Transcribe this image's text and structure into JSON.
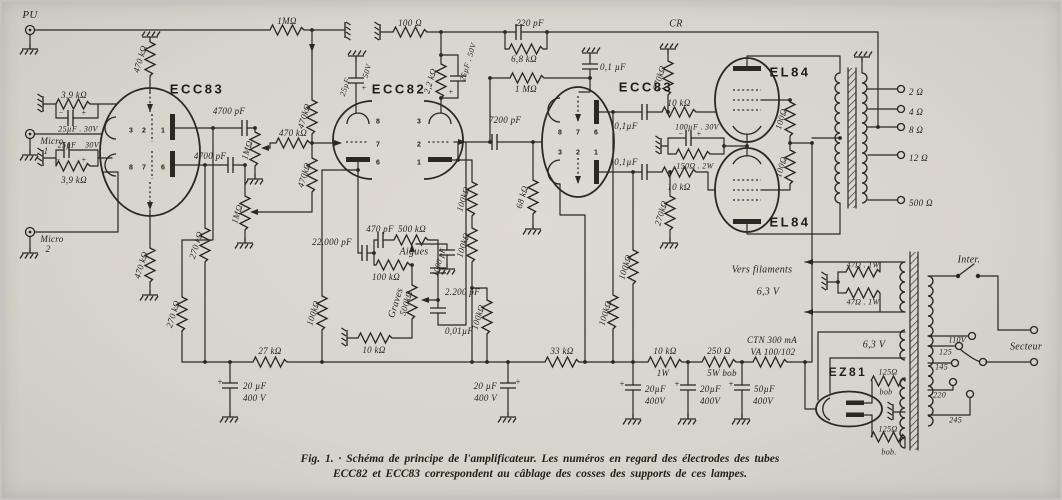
{
  "caption": {
    "line1": "Fig. 1. · Schéma de principe de l'amplificateur. Les numéros en regard des électrodes des tubes",
    "line2": "ECC82 et ECC83 correspondent au câblage des cosses des supports de ces lampes."
  },
  "colors": {
    "paper": "#d7d4cc",
    "ink": "#2b2723"
  },
  "labels": [
    {
      "n": "pu-label",
      "t": "PU",
      "x": 30,
      "y": 15,
      "s": 11
    },
    {
      "n": "micro1-label",
      "t": "Micro",
      "x": 52,
      "y": 141
    },
    {
      "n": "micro1-num",
      "t": "1",
      "x": 46,
      "y": 151
    },
    {
      "n": "micro2-label",
      "t": "Micro",
      "x": 52,
      "y": 239
    },
    {
      "n": "micro2-num",
      "t": "2",
      "x": 48,
      "y": 249
    },
    {
      "n": "r-1m-pu",
      "t": "1MΩ",
      "x": 287,
      "y": 21
    },
    {
      "n": "r-100",
      "t": "100 Ω",
      "x": 410,
      "y": 23
    },
    {
      "n": "c-220p",
      "t": "220 pF",
      "x": 530,
      "y": 23
    },
    {
      "n": "r-6k8",
      "t": "6,8 kΩ",
      "x": 524,
      "y": 59
    },
    {
      "n": "cr-label",
      "t": "CR",
      "x": 676,
      "y": 24,
      "s": 10
    },
    {
      "n": "c-01-c",
      "t": "0,1 µF",
      "x": 600,
      "y": 67,
      "a": "s"
    },
    {
      "n": "r-1m-grid",
      "t": "1 MΩ",
      "x": 526,
      "y": 89
    },
    {
      "n": "tube1-label",
      "t": "ECC83",
      "x": 197,
      "y": 89,
      "c": "tube"
    },
    {
      "n": "r-470k-p1",
      "t": "470 kΩ",
      "x": 140,
      "y": 59,
      "r": -73
    },
    {
      "n": "r-3k9-a",
      "t": "3,9 kΩ",
      "x": 74,
      "y": 95
    },
    {
      "n": "c-25u-a",
      "t": "25µF . 30V",
      "x": 78,
      "y": 129,
      "s": 8
    },
    {
      "n": "sign-m1",
      "t": "−",
      "x": 61,
      "y": 113,
      "s": 8
    },
    {
      "n": "sign-p1",
      "t": "+",
      "x": 84,
      "y": 113,
      "s": 8
    },
    {
      "n": "c-25u-b",
      "t": "25µF",
      "x": 67,
      "y": 145,
      "s": 8
    },
    {
      "n": "v-30-b",
      "t": "30V",
      "x": 92,
      "y": 145,
      "s": 8
    },
    {
      "n": "sign-m2",
      "t": "−",
      "x": 58,
      "y": 160,
      "s": 8
    },
    {
      "n": "sign-p2",
      "t": "+",
      "x": 84,
      "y": 160,
      "s": 8
    },
    {
      "n": "r-3k9-b",
      "t": "3,9 kΩ",
      "x": 74,
      "y": 180
    },
    {
      "n": "c-4700-a",
      "t": "4700 pF",
      "x": 229,
      "y": 111
    },
    {
      "n": "c-4700-b",
      "t": "4700 pF",
      "x": 210,
      "y": 156
    },
    {
      "n": "pot1-label",
      "t": "1MΩ",
      "x": 247,
      "y": 150,
      "r": -73
    },
    {
      "n": "pot2-label",
      "t": "1MΩ",
      "x": 237,
      "y": 214,
      "r": -73
    },
    {
      "n": "r-470k-mix",
      "t": "470 kΩ",
      "x": 293,
      "y": 133
    },
    {
      "n": "r-470k-v1",
      "t": "470kΩ",
      "x": 304,
      "y": 116,
      "r": -73
    },
    {
      "n": "r-470k-v2",
      "t": "470kΩ",
      "x": 304,
      "y": 175,
      "r": -73
    },
    {
      "n": "r-470k-gl",
      "t": "470 kΩ",
      "x": 141,
      "y": 265,
      "r": -73
    },
    {
      "n": "r-270k-a",
      "t": "270 kΩ",
      "x": 196,
      "y": 245,
      "r": -73
    },
    {
      "n": "r-270k-b",
      "t": "270 kΩ",
      "x": 173,
      "y": 314,
      "r": -73
    },
    {
      "n": "pin-t1-3",
      "t": "3",
      "x": 131,
      "y": 131,
      "c": "pin"
    },
    {
      "n": "pin-t1-2",
      "t": "2",
      "x": 144,
      "y": 131,
      "c": "pin"
    },
    {
      "n": "pin-t1-1",
      "t": "1",
      "x": 163,
      "y": 131,
      "c": "pin"
    },
    {
      "n": "pin-t1-8",
      "t": "8",
      "x": 131,
      "y": 168,
      "c": "pin"
    },
    {
      "n": "pin-t1-7",
      "t": "7",
      "x": 144,
      "y": 168,
      "c": "pin"
    },
    {
      "n": "pin-t1-6",
      "t": "6",
      "x": 163,
      "y": 168,
      "c": "pin"
    },
    {
      "n": "c-25u50-a",
      "t": "25µF",
      "x": 345,
      "y": 87,
      "r": -73,
      "s": 8
    },
    {
      "n": "v-50-a",
      "t": "50V",
      "x": 367,
      "y": 71,
      "r": -73,
      "s": 8
    },
    {
      "n": "sign-p10",
      "t": "+",
      "x": 364,
      "y": 88,
      "s": 8
    },
    {
      "n": "tube2-label",
      "t": "ECC82",
      "x": 399,
      "y": 89,
      "c": "tube"
    },
    {
      "n": "r-2k2",
      "t": "2,2 kΩ",
      "x": 430,
      "y": 81,
      "r": -73
    },
    {
      "n": "c-25u50-b",
      "t": "25µF . 50V",
      "x": 468,
      "y": 62,
      "r": -73,
      "s": 8
    },
    {
      "n": "sign-p3",
      "t": "+",
      "x": 451,
      "y": 92,
      "s": 8
    },
    {
      "n": "pin-t2-8",
      "t": "8",
      "x": 378,
      "y": 122,
      "c": "pin"
    },
    {
      "n": "pin-t2-7",
      "t": "7",
      "x": 378,
      "y": 145,
      "c": "pin"
    },
    {
      "n": "pin-t2-6",
      "t": "6",
      "x": 378,
      "y": 163,
      "c": "pin"
    },
    {
      "n": "pin-t2-3",
      "t": "3",
      "x": 419,
      "y": 122,
      "c": "pin"
    },
    {
      "n": "pin-t2-2",
      "t": "2",
      "x": 419,
      "y": 145,
      "c": "pin"
    },
    {
      "n": "pin-t2-1",
      "t": "1",
      "x": 419,
      "y": 163,
      "c": "pin"
    },
    {
      "n": "c-7200",
      "t": "7200 pF",
      "x": 505,
      "y": 120
    },
    {
      "n": "r-68k",
      "t": "68 kΩ",
      "x": 522,
      "y": 197,
      "r": -73
    },
    {
      "n": "c-22000",
      "t": "22.000 pF",
      "x": 332,
      "y": 242
    },
    {
      "n": "c-470p",
      "t": "470 pF",
      "x": 380,
      "y": 229
    },
    {
      "n": "pot-aigues",
      "t": "500 kΩ",
      "x": 412,
      "y": 229
    },
    {
      "n": "aigues-label",
      "t": "Aigues",
      "x": 414,
      "y": 252,
      "s": 10
    },
    {
      "n": "c-1000",
      "t": "1000 pF",
      "x": 439,
      "y": 262,
      "r": -73,
      "s": 8
    },
    {
      "n": "r-100k-tone",
      "t": "100 kΩ",
      "x": 386,
      "y": 277
    },
    {
      "n": "graves-label",
      "t": "Graves",
      "x": 396,
      "y": 303,
      "r": -73,
      "s": 10
    },
    {
      "n": "pot-graves",
      "t": "500kΩ",
      "x": 406,
      "y": 303,
      "r": -73
    },
    {
      "n": "c-2200",
      "t": "2.200  pF",
      "x": 445,
      "y": 292,
      "a": "s"
    },
    {
      "n": "c-001",
      "t": "0,01µF",
      "x": 445,
      "y": 331,
      "a": "s"
    },
    {
      "n": "r-10k-tone",
      "t": "10 kΩ",
      "x": 374,
      "y": 350
    },
    {
      "n": "r-100k-sup",
      "t": "100kΩ",
      "x": 313,
      "y": 313,
      "r": -73
    },
    {
      "n": "r-100k-a",
      "t": "100kΩ",
      "x": 463,
      "y": 199,
      "r": -73
    },
    {
      "n": "r-100k-b",
      "t": "100kΩ",
      "x": 463,
      "y": 245,
      "r": -73
    },
    {
      "n": "r-100k-c",
      "t": "100kΩ",
      "x": 478,
      "y": 317,
      "r": -73
    },
    {
      "n": "tube3-label",
      "t": "ECC83",
      "x": 646,
      "y": 87,
      "c": "tube"
    },
    {
      "n": "pin-t3-8",
      "t": "8",
      "x": 560,
      "y": 133,
      "c": "pin"
    },
    {
      "n": "pin-t3-7",
      "t": "7",
      "x": 578,
      "y": 133,
      "c": "pin"
    },
    {
      "n": "pin-t3-6",
      "t": "6",
      "x": 596,
      "y": 133,
      "c": "pin"
    },
    {
      "n": "pin-t3-3",
      "t": "3",
      "x": 560,
      "y": 153,
      "c": "pin"
    },
    {
      "n": "pin-t3-2",
      "t": "2",
      "x": 578,
      "y": 153,
      "c": "pin"
    },
    {
      "n": "pin-t3-1",
      "t": "1",
      "x": 596,
      "y": 153,
      "c": "pin"
    },
    {
      "n": "r-270k-c",
      "t": "270kΩ",
      "x": 659,
      "y": 78,
      "r": -73
    },
    {
      "n": "r-270k-d",
      "t": "270kΩ",
      "x": 661,
      "y": 213,
      "r": -73
    },
    {
      "n": "c-01-a",
      "t": "0,1µF",
      "x": 626,
      "y": 126
    },
    {
      "n": "c-01-b",
      "t": "0,1µF",
      "x": 626,
      "y": 162
    },
    {
      "n": "r-10k-a",
      "t": "10 kΩ",
      "x": 679,
      "y": 103
    },
    {
      "n": "r-10k-b",
      "t": "10 kΩ",
      "x": 679,
      "y": 187
    },
    {
      "n": "c-100u",
      "t": "100µF . 30V",
      "x": 697,
      "y": 127,
      "s": 8
    },
    {
      "n": "sign-m3",
      "t": "−",
      "x": 681,
      "y": 134,
      "s": 8
    },
    {
      "n": "sign-p4",
      "t": "+",
      "x": 699,
      "y": 134,
      "s": 8
    },
    {
      "n": "r-150",
      "t": "150Ω . 2W",
      "x": 695,
      "y": 166,
      "s": 8
    },
    {
      "n": "r-100k-d",
      "t": "100kΩ",
      "x": 605,
      "y": 313,
      "r": -73
    },
    {
      "n": "r-100k-e",
      "t": "100kΩ",
      "x": 625,
      "y": 267,
      "r": -73
    },
    {
      "n": "tube4-label",
      "t": "EL84",
      "x": 790,
      "y": 72,
      "c": "tube"
    },
    {
      "n": "tube5-label",
      "t": "EL84",
      "x": 790,
      "y": 222,
      "c": "tube"
    },
    {
      "n": "r-100-s1",
      "t": "100Ω",
      "x": 781,
      "y": 119,
      "r": -73
    },
    {
      "n": "r-100-s2",
      "t": "100Ω",
      "x": 781,
      "y": 167,
      "r": -73
    },
    {
      "n": "tap-2",
      "t": "2 Ω",
      "x": 909,
      "y": 92,
      "a": "s"
    },
    {
      "n": "tap-4",
      "t": "4 Ω",
      "x": 909,
      "y": 112,
      "a": "s"
    },
    {
      "n": "tap-8",
      "t": "8 Ω",
      "x": 909,
      "y": 130,
      "a": "s"
    },
    {
      "n": "tap-12",
      "t": "12 Ω",
      "x": 909,
      "y": 158,
      "a": "s"
    },
    {
      "n": "tap-500",
      "t": "500 Ω",
      "x": 909,
      "y": 203,
      "a": "s"
    },
    {
      "n": "r-27k",
      "t": "27 kΩ",
      "x": 270,
      "y": 351
    },
    {
      "n": "c-20u-1",
      "t": "20 µF",
      "x": 243,
      "y": 386,
      "a": "s"
    },
    {
      "n": "v-400-1",
      "t": "400 V",
      "x": 243,
      "y": 398,
      "a": "s"
    },
    {
      "n": "sign-p5",
      "t": "+",
      "x": 220,
      "y": 382
    },
    {
      "n": "r-33k",
      "t": "33 kΩ",
      "x": 562,
      "y": 351
    },
    {
      "n": "c-20u-2",
      "t": "20 µF",
      "x": 497,
      "y": 386,
      "a": "e"
    },
    {
      "n": "v-400-2",
      "t": "400 V",
      "x": 497,
      "y": 398,
      "a": "e"
    },
    {
      "n": "sign-p6",
      "t": "+",
      "x": 518,
      "y": 382
    },
    {
      "n": "r-10k-psu",
      "t": "10 kΩ",
      "x": 665,
      "y": 351
    },
    {
      "n": "w-1w",
      "t": "1W",
      "x": 663,
      "y": 373
    },
    {
      "n": "r-250",
      "t": "250 Ω",
      "x": 719,
      "y": 351
    },
    {
      "n": "w-5w",
      "t": "5W bob",
      "x": 722,
      "y": 373
    },
    {
      "n": "ctn-1",
      "t": "CTN 300 mA",
      "x": 772,
      "y": 340
    },
    {
      "n": "ctn-2",
      "t": "VA 100/102",
      "x": 773,
      "y": 352
    },
    {
      "n": "c-20u-3",
      "t": "20µF",
      "x": 645,
      "y": 389,
      "a": "s"
    },
    {
      "n": "v-400-3",
      "t": "400V",
      "x": 645,
      "y": 401,
      "a": "s"
    },
    {
      "n": "sign-p7",
      "t": "+",
      "x": 622,
      "y": 384
    },
    {
      "n": "c-20u-4",
      "t": "20µF",
      "x": 700,
      "y": 389,
      "a": "s"
    },
    {
      "n": "v-400-4",
      "t": "400V",
      "x": 700,
      "y": 401,
      "a": "s"
    },
    {
      "n": "sign-p8",
      "t": "+",
      "x": 677,
      "y": 384
    },
    {
      "n": "c-50u",
      "t": "50µF",
      "x": 754,
      "y": 389,
      "a": "s"
    },
    {
      "n": "v-400-5",
      "t": "400V",
      "x": 753,
      "y": 401,
      "a": "s"
    },
    {
      "n": "sign-p9",
      "t": "+",
      "x": 731,
      "y": 384
    },
    {
      "n": "vers-filaments",
      "t": "Vers filaments",
      "x": 762,
      "y": 270,
      "s": 10
    },
    {
      "n": "v-63-1",
      "t": "6,3 V",
      "x": 768,
      "y": 292,
      "s": 10
    },
    {
      "n": "r-47-1",
      "t": "47Ω . 1W",
      "x": 863,
      "y": 265,
      "s": 8
    },
    {
      "n": "r-47-2",
      "t": "47Ω . 1W",
      "x": 863,
      "y": 302,
      "s": 8
    },
    {
      "n": "v-63-2",
      "t": "6,3 V",
      "x": 874,
      "y": 345,
      "s": 10
    },
    {
      "n": "tube6-label",
      "t": "EZ81",
      "x": 848,
      "y": 372,
      "c": "tube",
      "s": 12
    },
    {
      "n": "r-125-1",
      "t": "125Ω",
      "x": 888,
      "y": 372,
      "s": 8
    },
    {
      "n": "bob-1",
      "t": "bob",
      "x": 886,
      "y": 392,
      "s": 8
    },
    {
      "n": "r-125-2",
      "t": "125Ω",
      "x": 888,
      "y": 429,
      "s": 8
    },
    {
      "n": "bob-2",
      "t": "bob.",
      "x": 889,
      "y": 452,
      "s": 8
    },
    {
      "n": "inter-label",
      "t": "Inter.",
      "x": 969,
      "y": 260,
      "s": 10
    },
    {
      "n": "secteur-label",
      "t": "Secteur",
      "x": 1026,
      "y": 347,
      "s": 10
    },
    {
      "n": "v-110",
      "t": "110V",
      "x": 966,
      "y": 340,
      "a": "e",
      "s": 8
    },
    {
      "n": "v-125",
      "t": "125",
      "x": 952,
      "y": 352,
      "a": "e",
      "s": 8
    },
    {
      "n": "v-145",
      "t": "145",
      "x": 948,
      "y": 367,
      "a": "e",
      "s": 8
    },
    {
      "n": "v-220",
      "t": "220",
      "x": 946,
      "y": 395,
      "a": "e",
      "s": 8
    },
    {
      "n": "v-245",
      "t": "245",
      "x": 962,
      "y": 420,
      "a": "e",
      "s": 8
    }
  ]
}
